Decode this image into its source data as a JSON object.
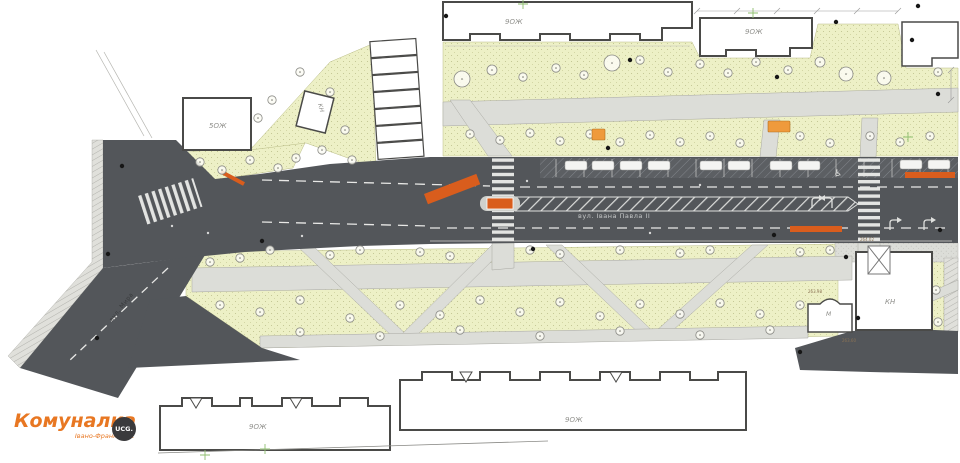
{
  "logo": {
    "title": "Комуналка",
    "subtitle": "Івано-Франківськ",
    "badge": "UCG."
  },
  "streets": {
    "main": "вул. Івана Павла II",
    "side": "вул. Мира"
  },
  "buildings": {
    "top_center": "9ОЖ",
    "top_right": "9ОЖ",
    "bottom_left": "9ОЖ",
    "bottom_right": "9ОЖ",
    "left_block": "5ОЖ",
    "left_small": "КН",
    "right_block": "КН",
    "right_shop": "М"
  },
  "elevations": [
    "264.02",
    "263.98",
    "263.60"
  ],
  "colors": {
    "lawn": "#edf0c6",
    "road": "#53565a",
    "walkway": "#dcddd8",
    "marking": "#e3e4e2",
    "bus_stop_orange": "#d95d1d",
    "furniture_orange": "#ef9a3c",
    "logo_orange": "#e87722",
    "badge_dark": "#3a3a3c"
  }
}
